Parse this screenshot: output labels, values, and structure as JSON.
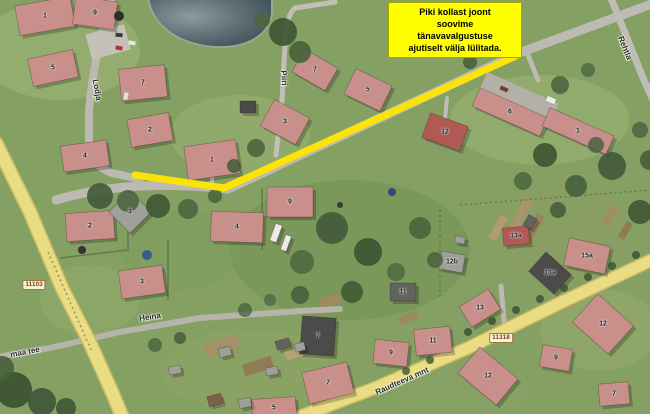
{
  "title": "Aerial map – temporary street lighting switch-off request",
  "annotation": {
    "lines": [
      "Piki kollast joont",
      "soovime",
      "tänavavalgustuse",
      "ajutiselt välja lülitada."
    ],
    "bg_color": "#ffff00",
    "text_color": "#000000"
  },
  "map": {
    "highlight_color": "#ffe600",
    "road_refs": [
      {
        "text": "11103",
        "x": 34,
        "y": 285
      },
      {
        "text": "11318",
        "x": 501,
        "y": 338
      }
    ],
    "street_labels": [
      {
        "text": "Lodja",
        "x": 97,
        "y": 90,
        "rot": 80
      },
      {
        "text": "Piiri",
        "x": 284,
        "y": 78,
        "rot": 86
      },
      {
        "text": "Rehtla",
        "x": 625,
        "y": 48,
        "rot": 68
      },
      {
        "text": "maa tee",
        "x": 25,
        "y": 352,
        "rot": -11
      },
      {
        "text": "Heina",
        "x": 150,
        "y": 317,
        "rot": -9
      },
      {
        "text": "Raudteeva mnt",
        "x": 402,
        "y": 381,
        "rot": -24
      }
    ],
    "houses": [
      {
        "label": "1",
        "x": 45,
        "y": 16,
        "w": 56,
        "h": 30,
        "rot": -10,
        "roof": "pink"
      },
      {
        "label": "9",
        "x": 95,
        "y": 13,
        "w": 42,
        "h": 28,
        "rot": 8,
        "roof": "pink"
      },
      {
        "label": "5",
        "x": 53,
        "y": 68,
        "w": 46,
        "h": 28,
        "rot": -12,
        "roof": "pink"
      },
      {
        "label": "7",
        "x": 143,
        "y": 83,
        "w": 46,
        "h": 32,
        "rot": -6,
        "roof": "pink"
      },
      {
        "label": "4",
        "x": 85,
        "y": 156,
        "w": 46,
        "h": 26,
        "rot": -8,
        "roof": "pink"
      },
      {
        "label": "2",
        "x": 150,
        "y": 130,
        "w": 42,
        "h": 28,
        "rot": -10,
        "roof": "pink"
      },
      {
        "label": "1",
        "x": 212,
        "y": 160,
        "w": 52,
        "h": 34,
        "rot": -8,
        "roof": "pink"
      },
      {
        "label": "3",
        "x": 285,
        "y": 122,
        "w": 40,
        "h": 30,
        "rot": 28,
        "roof": "pink"
      },
      {
        "label": "7",
        "x": 315,
        "y": 70,
        "w": 38,
        "h": 26,
        "rot": 30,
        "roof": "pink"
      },
      {
        "label": "5",
        "x": 368,
        "y": 90,
        "w": 40,
        "h": 28,
        "rot": 26,
        "roof": "pink"
      },
      {
        "label": "12",
        "x": 445,
        "y": 132,
        "w": 40,
        "h": 26,
        "rot": 20,
        "roof": "red"
      },
      {
        "label": "6",
        "x": 510,
        "y": 112,
        "w": 74,
        "h": 20,
        "rot": 24,
        "roof": "pink"
      },
      {
        "label": "1",
        "x": 578,
        "y": 131,
        "w": 70,
        "h": 20,
        "rot": 24,
        "roof": "pink"
      },
      {
        "label": "2",
        "x": 90,
        "y": 226,
        "w": 48,
        "h": 28,
        "rot": -4,
        "roof": "pink"
      },
      {
        "label": "3",
        "x": 130,
        "y": 212,
        "w": 30,
        "h": 30,
        "rot": 45,
        "roof": "gray"
      },
      {
        "label": "3",
        "x": 142,
        "y": 282,
        "w": 44,
        "h": 28,
        "rot": -8,
        "roof": "pink"
      },
      {
        "label": "9",
        "x": 290,
        "y": 202,
        "w": 46,
        "h": 30,
        "rot": 0,
        "roof": "pink"
      },
      {
        "label": "4",
        "x": 237,
        "y": 227,
        "w": 52,
        "h": 30,
        "rot": 2,
        "roof": "pink"
      },
      {
        "label": "11",
        "x": 403,
        "y": 292,
        "w": 26,
        "h": 18,
        "rot": 0,
        "roof": "dark"
      },
      {
        "label": "7",
        "x": 318,
        "y": 336,
        "w": 34,
        "h": 38,
        "rot": 4,
        "roof": "charcoal"
      },
      {
        "label": "7",
        "x": 328,
        "y": 383,
        "w": 46,
        "h": 32,
        "rot": -14,
        "roof": "pink"
      },
      {
        "label": "9",
        "x": 391,
        "y": 353,
        "w": 34,
        "h": 24,
        "rot": 6,
        "roof": "pink"
      },
      {
        "label": "11",
        "x": 433,
        "y": 341,
        "w": 36,
        "h": 26,
        "rot": -6,
        "roof": "pink"
      },
      {
        "label": "5",
        "x": 274,
        "y": 408,
        "w": 44,
        "h": 20,
        "rot": -4,
        "roof": "pink"
      },
      {
        "label": "12b",
        "x": 452,
        "y": 262,
        "w": 24,
        "h": 18,
        "rot": 10,
        "roof": "gray"
      },
      {
        "label": "13a",
        "x": 516,
        "y": 236,
        "w": 26,
        "h": 18,
        "rot": -5,
        "roof": "red"
      },
      {
        "label": "13a",
        "x": 550,
        "y": 273,
        "w": 34,
        "h": 26,
        "rot": 42,
        "roof": "charcoal"
      },
      {
        "label": "15a",
        "x": 587,
        "y": 256,
        "w": 42,
        "h": 28,
        "rot": 12,
        "roof": "pink"
      },
      {
        "label": "13",
        "x": 480,
        "y": 308,
        "w": 34,
        "h": 24,
        "rot": -32,
        "roof": "pink"
      },
      {
        "label": "12",
        "x": 603,
        "y": 324,
        "w": 48,
        "h": 38,
        "rot": 42,
        "roof": "pink"
      },
      {
        "label": "12",
        "x": 488,
        "y": 376,
        "w": 50,
        "h": 34,
        "rot": 40,
        "roof": "pink"
      },
      {
        "label": "9",
        "x": 556,
        "y": 358,
        "w": 30,
        "h": 22,
        "rot": 10,
        "roof": "pink"
      },
      {
        "label": "7",
        "x": 614,
        "y": 394,
        "w": 30,
        "h": 22,
        "rot": -5,
        "roof": "pink"
      },
      {
        "label": "",
        "x": 248,
        "y": 107,
        "w": 16,
        "h": 12,
        "rot": 0,
        "roof": "charcoal"
      },
      {
        "label": "",
        "x": 225,
        "y": 352,
        "w": 12,
        "h": 9,
        "rot": -15,
        "roof": "gray"
      },
      {
        "label": "",
        "x": 283,
        "y": 344,
        "w": 14,
        "h": 9,
        "rot": -15,
        "roof": "dark"
      },
      {
        "label": "",
        "x": 272,
        "y": 371,
        "w": 12,
        "h": 8,
        "rot": -10,
        "roof": "gray"
      },
      {
        "label": "",
        "x": 215,
        "y": 400,
        "w": 14,
        "h": 10,
        "rot": -15,
        "roof": "brown"
      },
      {
        "label": "",
        "x": 245,
        "y": 403,
        "w": 12,
        "h": 9,
        "rot": -12,
        "roof": "gray"
      },
      {
        "label": "",
        "x": 300,
        "y": 347,
        "w": 10,
        "h": 8,
        "rot": -15,
        "roof": "gray"
      },
      {
        "label": "",
        "x": 530,
        "y": 222,
        "w": 12,
        "h": 9,
        "rot": -60,
        "roof": "dark"
      },
      {
        "label": "",
        "x": 460,
        "y": 240,
        "w": 10,
        "h": 7,
        "rot": 10,
        "roof": "gray"
      },
      {
        "label": "",
        "x": 276,
        "y": 233,
        "w": 18,
        "h": 7,
        "rot": -70,
        "roof": "white"
      },
      {
        "label": "",
        "x": 286,
        "y": 243,
        "w": 16,
        "h": 6,
        "rot": -70,
        "roof": "white"
      },
      {
        "label": "",
        "x": 175,
        "y": 370,
        "w": 12,
        "h": 8,
        "rot": -10,
        "roof": "gray"
      }
    ]
  }
}
